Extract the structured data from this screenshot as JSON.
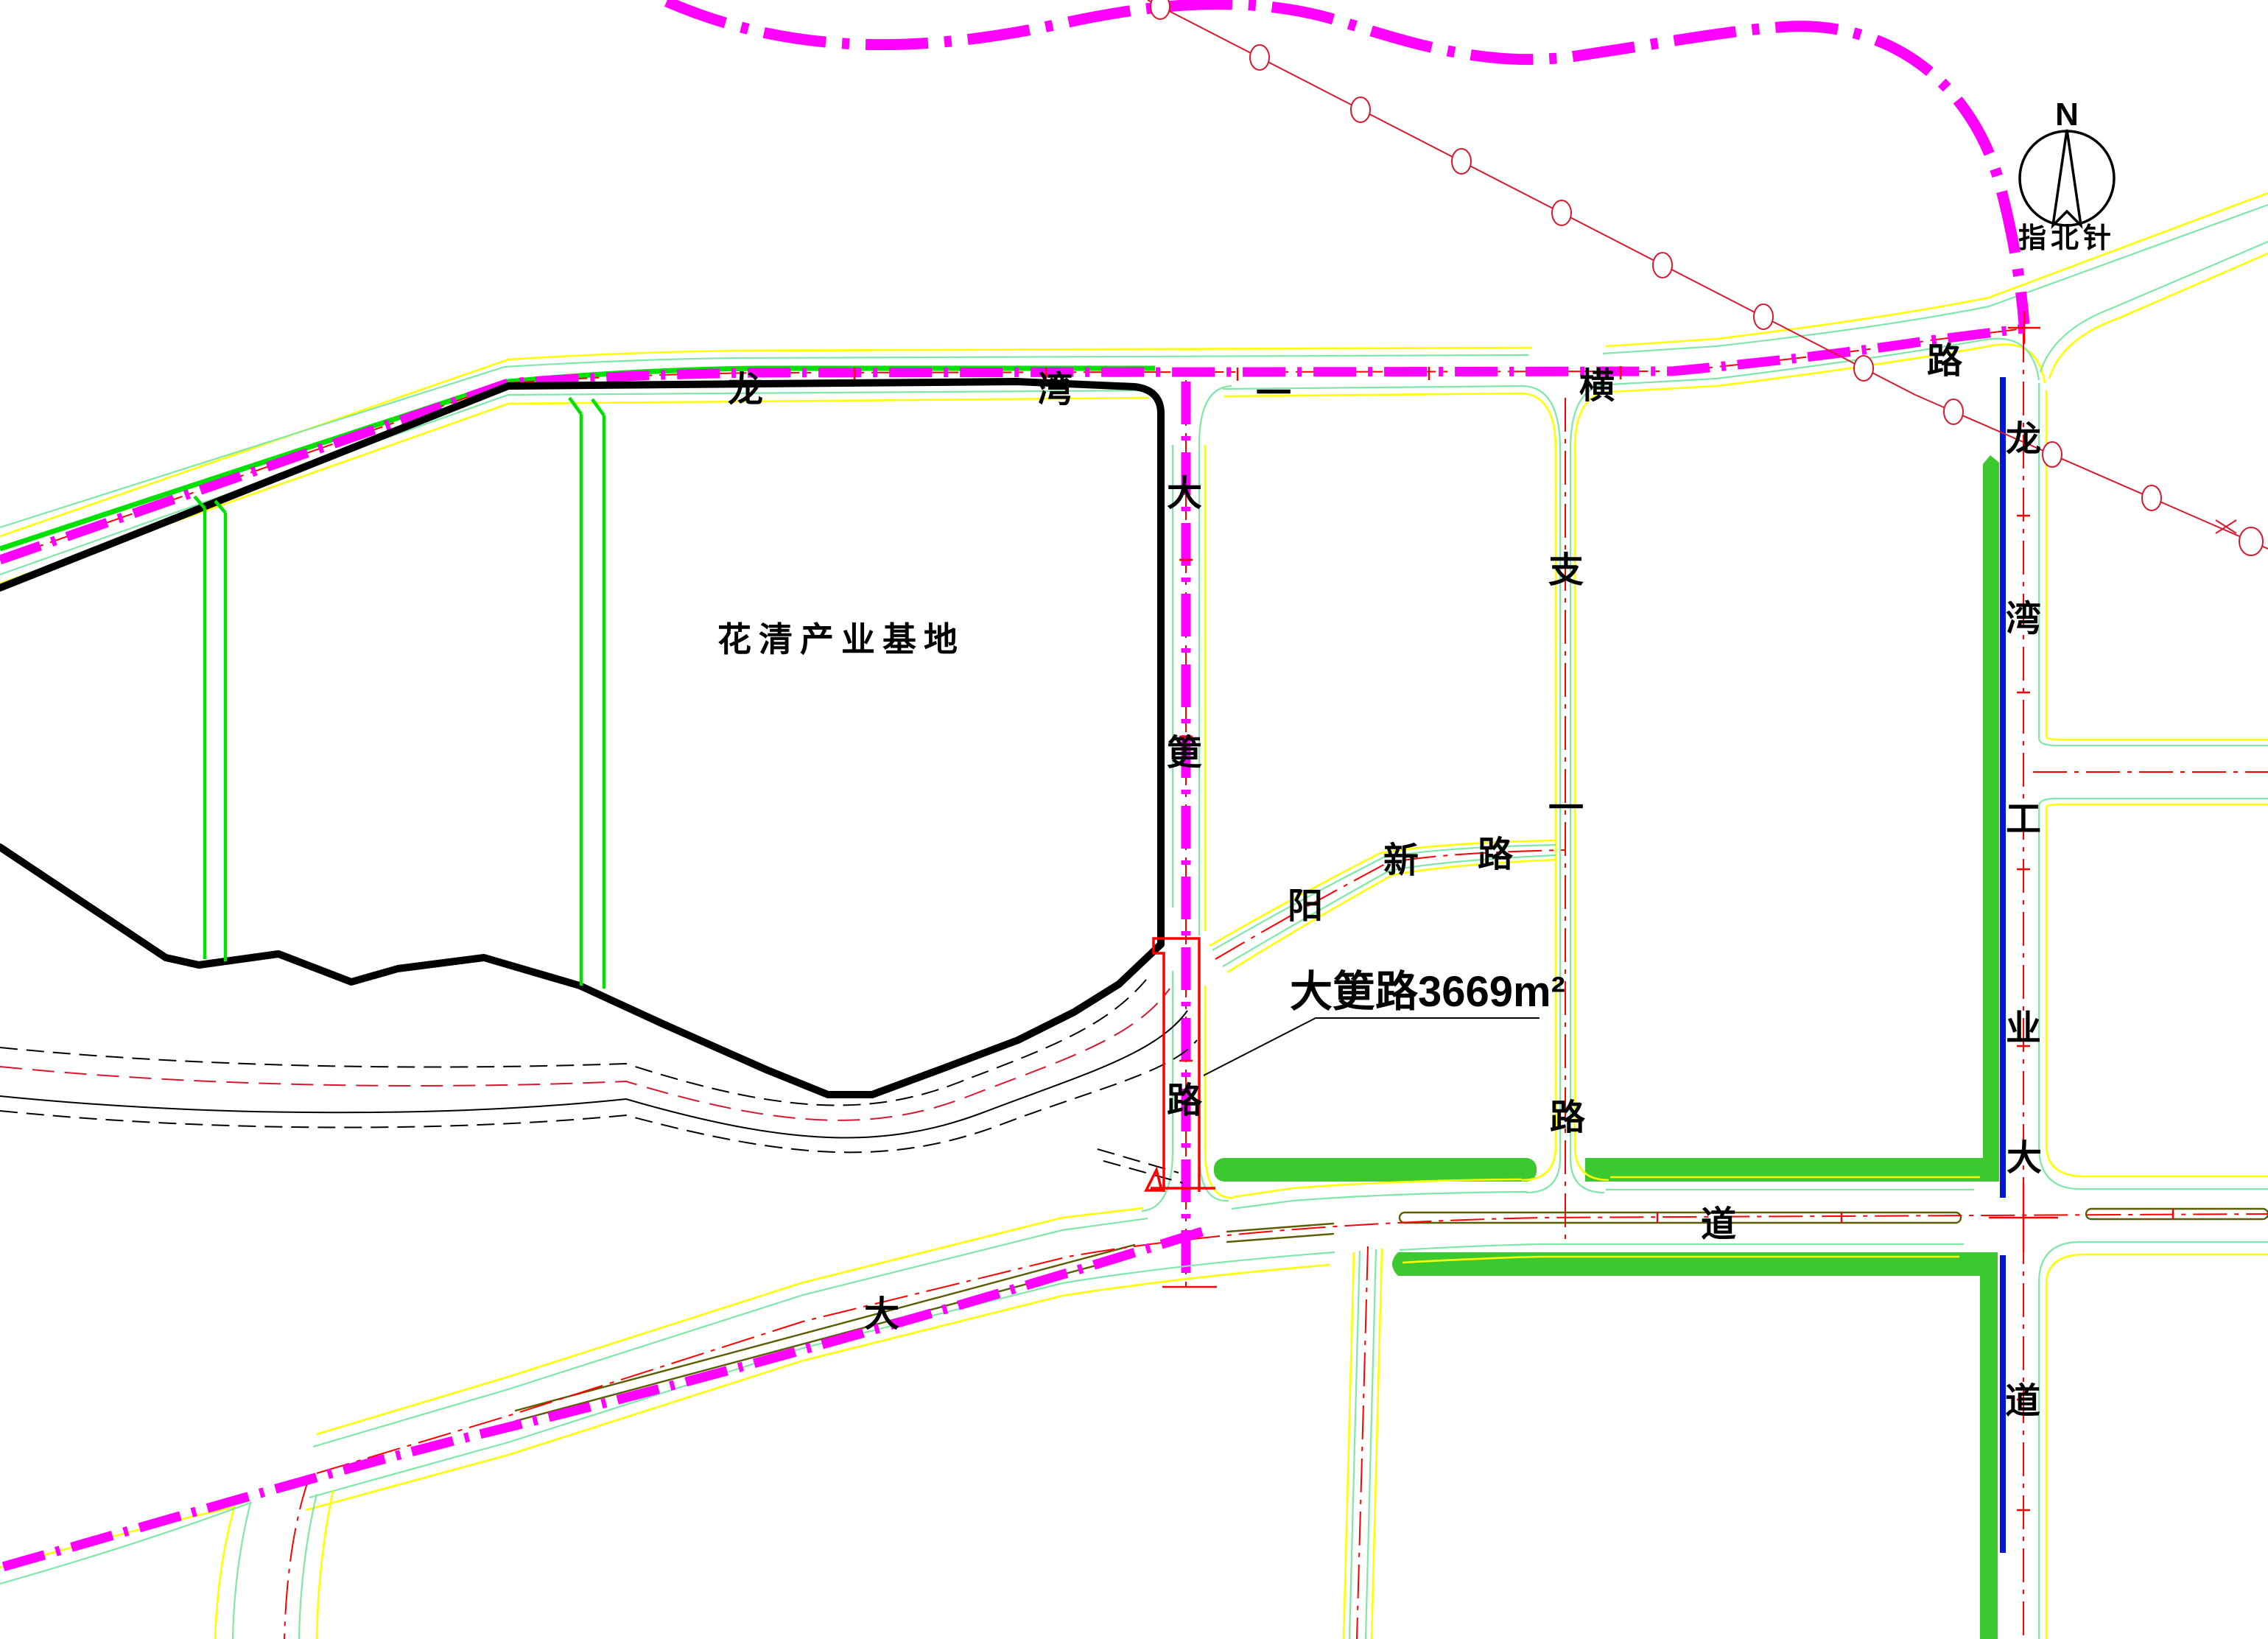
{
  "map": {
    "compass": {
      "north": "N",
      "label": "指北针"
    },
    "site_label": "花清产业基地",
    "annotation": "大筻路3669m²",
    "roads": {
      "top": [
        "龙",
        "湾",
        "一",
        "横",
        "路"
      ],
      "dagang": [
        "大",
        "筻",
        "路"
      ],
      "zhiyi": [
        "支",
        "一",
        "路"
      ],
      "yangxin": [
        "阳",
        "新",
        "路"
      ],
      "bottom": [
        "大",
        "道"
      ],
      "avenue": [
        "龙",
        "湾",
        "工",
        "业",
        "大",
        "道"
      ]
    },
    "colors": {
      "planning_boundary": "#ff00ff",
      "road_centerline": "#ff0000",
      "survey_line": "#d81830",
      "green_line": "#00e100",
      "green_belt": "#3bc92f",
      "blue_line": "#0017d8",
      "yellow_edge": "#ffff00",
      "light_green_edge": "#7fe8a8",
      "olive_median": "#5c5c00",
      "site_outline": "#000000"
    }
  }
}
